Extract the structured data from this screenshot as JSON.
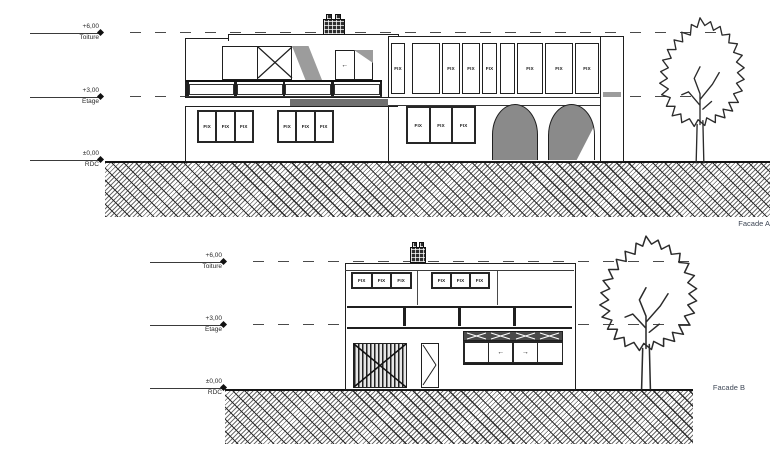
{
  "levels": [
    {
      "value": "+6,00",
      "name": "Toiture"
    },
    {
      "value": "+3,00",
      "name": "Etage"
    },
    {
      "value": "±0,00",
      "name": "RDC"
    }
  ],
  "colors": {
    "line": "#1f1f1f",
    "dashed_line": "#4a4a4a",
    "arch_fill": "#8a8a8a",
    "shadow_fill": "#9c9c9c",
    "slab_dark": "#707070",
    "transom_fill": "#4a4a4a",
    "label_text": "#3e4756"
  },
  "facade_a": {
    "label": "Facade A",
    "upper_band_windows": [
      "FIX",
      "",
      "FIX",
      "FIX",
      "FIX",
      "",
      "FIX",
      "FIX",
      "FIX"
    ],
    "ground_window_groups": [
      {
        "panes": [
          "FIX",
          "FIX",
          "FIX"
        ]
      },
      {
        "panes": [
          "FIX",
          "FIX",
          "FIX"
        ]
      },
      {
        "panes": [
          "FIX",
          "FIX",
          "FIX"
        ]
      }
    ],
    "door_arrow": "←"
  },
  "facade_b": {
    "label": "Facade B",
    "upper_window_groups": [
      {
        "panes": [
          "FIX",
          "FIX",
          "FIX"
        ]
      },
      {
        "panes": [
          "FIX",
          "FIX",
          "FIX"
        ]
      }
    ],
    "slider_arrows": [
      "←",
      "→"
    ]
  }
}
